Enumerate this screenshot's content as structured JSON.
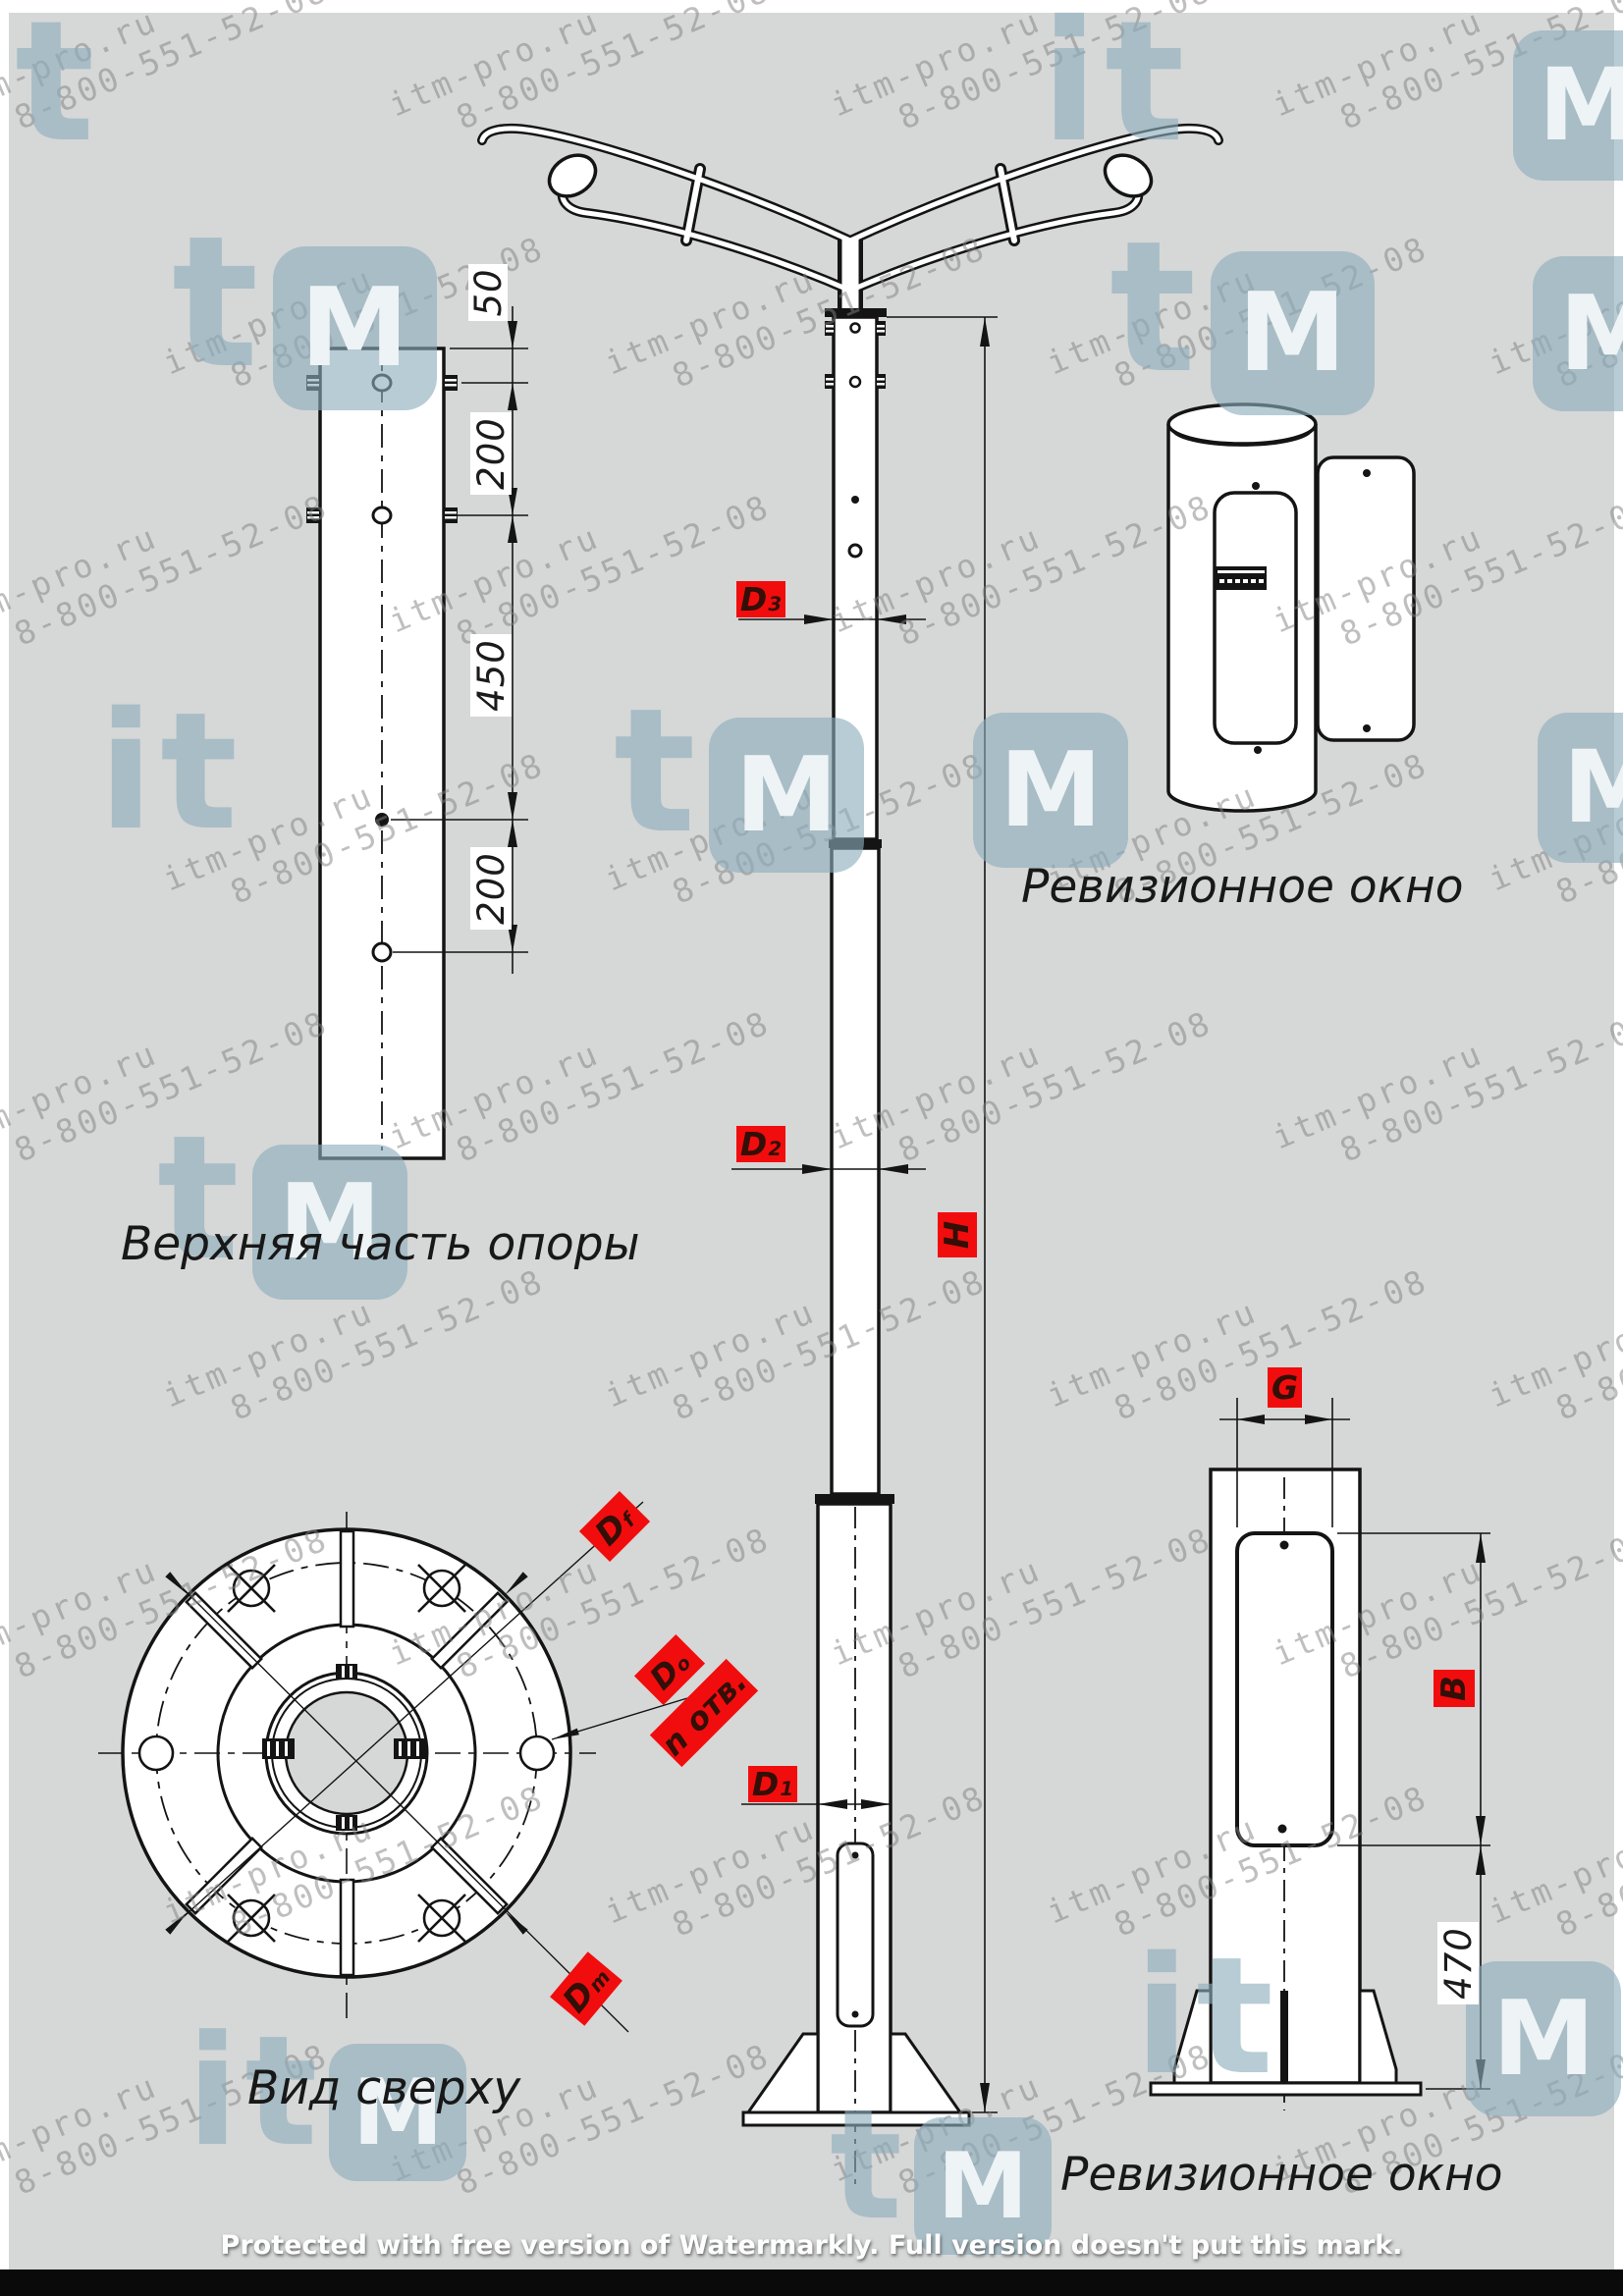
{
  "watermark": {
    "site": "itm-pro.ru",
    "phone": "8-800-551-52-08",
    "logo_letters": "itm"
  },
  "captions": {
    "upper_part": "Верхняя часть опоры",
    "revision_window_top": "Ревизионное окно",
    "top_view": "Вид сверху",
    "revision_window_bottom": "Ревизионное окно"
  },
  "dims": {
    "accent": "#f10d0d",
    "chain": [
      "50",
      "200",
      "450",
      "200"
    ],
    "base_height": "470",
    "labels": {
      "d3": {
        "b": "D",
        "s": "3"
      },
      "d2": {
        "b": "D",
        "s": "2"
      },
      "d1": {
        "b": "D",
        "s": "1"
      },
      "h": "H",
      "g": "G",
      "bdim": "B",
      "df": {
        "b": "D",
        "s": "f"
      },
      "do": {
        "b": "D",
        "s": "о"
      },
      "n_holes": "n отв.",
      "dm": {
        "b": "D",
        "s": "m"
      }
    }
  },
  "footer": {
    "text": "Protected with free version of Watermarkly. Full version doesn't put this mark."
  }
}
